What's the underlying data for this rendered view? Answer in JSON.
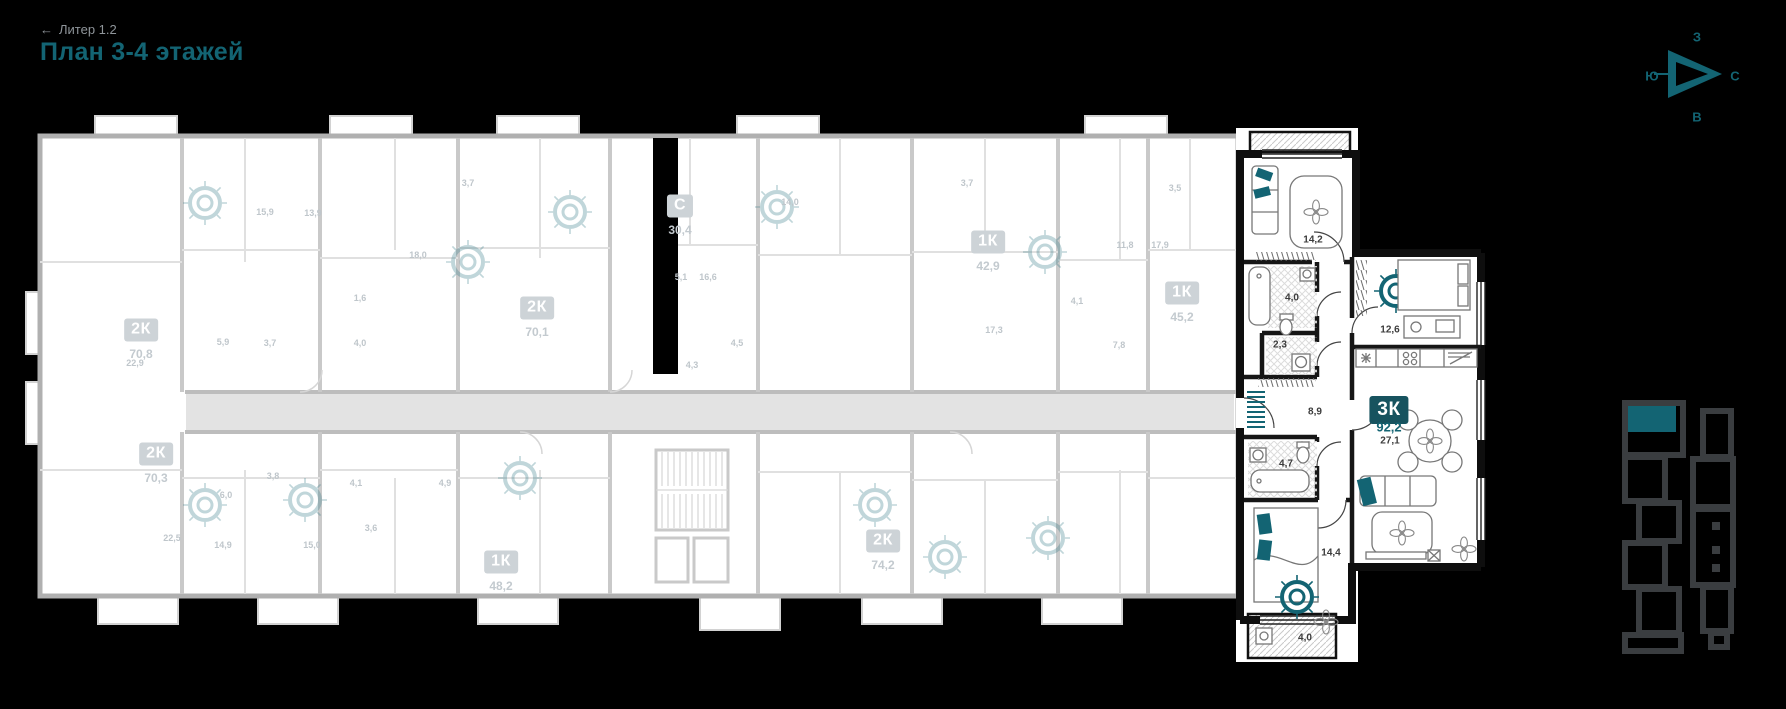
{
  "header": {
    "back_link": {
      "arrow": "←",
      "label": "Литер 1.2"
    },
    "title": "План 3-4 этажей"
  },
  "compass": {
    "top": "З",
    "left": "Ю",
    "right": "С",
    "bottom": "В"
  },
  "highlighted_unit": {
    "badge": "3К",
    "total_area": "92,2",
    "room_labels": [
      {
        "text": "14,2",
        "x": 1313,
        "y": 240
      },
      {
        "text": "4,0",
        "x": 1292,
        "y": 298
      },
      {
        "text": "2,3",
        "x": 1280,
        "y": 345
      },
      {
        "text": "8,9",
        "x": 1315,
        "y": 412
      },
      {
        "text": "4,7",
        "x": 1286,
        "y": 464
      },
      {
        "text": "14,4",
        "x": 1331,
        "y": 553
      },
      {
        "text": "12,6",
        "x": 1390,
        "y": 330
      },
      {
        "text": "27,1",
        "x": 1390,
        "y": 441
      },
      {
        "text": "4,0",
        "x": 1305,
        "y": 638
      }
    ]
  },
  "units": [
    {
      "type": "2К",
      "area": "70,8",
      "x": 141,
      "y": 330
    },
    {
      "type": "2К",
      "area": "70,3",
      "x": 156,
      "y": 454
    },
    {
      "type": "2К",
      "area": "70,1",
      "x": 537,
      "y": 308
    },
    {
      "type": "С",
      "area": "30,4",
      "x": 680,
      "y": 206
    },
    {
      "type": "1К",
      "area": "42,9",
      "x": 988,
      "y": 242
    },
    {
      "type": "1К",
      "area": "45,2",
      "x": 1182,
      "y": 293
    },
    {
      "type": "1К",
      "area": "48,2",
      "x": 501,
      "y": 562
    },
    {
      "type": "2К",
      "area": "74,2",
      "x": 883,
      "y": 541
    }
  ],
  "grey_area_labels": [
    {
      "text": "15,9",
      "x": 265,
      "y": 212
    },
    {
      "text": "13,9",
      "x": 313,
      "y": 213
    },
    {
      "text": "3,7",
      "x": 468,
      "y": 183
    },
    {
      "text": "18,0",
      "x": 418,
      "y": 255
    },
    {
      "text": "1,6",
      "x": 360,
      "y": 298
    },
    {
      "text": "5,9",
      "x": 223,
      "y": 342
    },
    {
      "text": "3,7",
      "x": 270,
      "y": 343
    },
    {
      "text": "4,0",
      "x": 360,
      "y": 343
    },
    {
      "text": "22,9",
      "x": 135,
      "y": 363
    },
    {
      "text": "22,5",
      "x": 172,
      "y": 538
    },
    {
      "text": "6,0",
      "x": 226,
      "y": 495
    },
    {
      "text": "3,8",
      "x": 273,
      "y": 476
    },
    {
      "text": "14,9",
      "x": 223,
      "y": 545
    },
    {
      "text": "15,0",
      "x": 312,
      "y": 545
    },
    {
      "text": "4,1",
      "x": 356,
      "y": 483
    },
    {
      "text": "4,9",
      "x": 445,
      "y": 483
    },
    {
      "text": "3,6",
      "x": 371,
      "y": 528
    },
    {
      "text": "5,1",
      "x": 681,
      "y": 277
    },
    {
      "text": "16,6",
      "x": 708,
      "y": 277
    },
    {
      "text": "4,3",
      "x": 692,
      "y": 365
    },
    {
      "text": "4,5",
      "x": 737,
      "y": 343
    },
    {
      "text": "14,0",
      "x": 790,
      "y": 202
    },
    {
      "text": "3,7",
      "x": 967,
      "y": 183
    },
    {
      "text": "3,5",
      "x": 1175,
      "y": 188
    },
    {
      "text": "11,8",
      "x": 1125,
      "y": 245
    },
    {
      "text": "17,9",
      "x": 1160,
      "y": 245
    },
    {
      "text": "17,3",
      "x": 994,
      "y": 330
    },
    {
      "text": "4,1",
      "x": 1077,
      "y": 301
    },
    {
      "text": "7,8",
      "x": 1119,
      "y": 345
    }
  ],
  "colors": {
    "background": "#000000",
    "accent_teal": "#136473",
    "highlight_badge_bg": "#17535f",
    "grey_badge_bg": "#cdd3d7",
    "grey_text": "#c3cacf",
    "minimap_grey": "#3a3d40"
  }
}
